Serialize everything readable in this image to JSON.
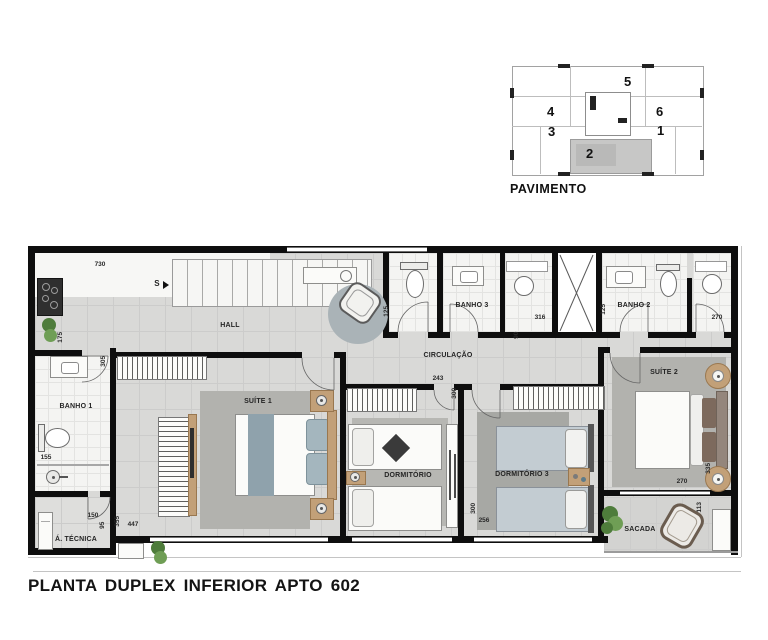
{
  "title": "PLANTA DUPLEX INFERIOR APTO 602",
  "keyplan": {
    "caption": "PAVIMENTO",
    "units": {
      "u1": "1",
      "u2": "2",
      "u3": "3",
      "u4": "4",
      "u5": "5",
      "u6": "6"
    }
  },
  "rooms": {
    "hall": "HALL",
    "circulacao": "CIRCULAÇÃO",
    "banho1": "BANHO 1",
    "banho2": "BANHO 2",
    "banho3": "BANHO 3",
    "suite1": "SUÍTE 1",
    "suite2": "SUÍTE 2",
    "dormitorio": "DORMITÓRIO",
    "dormitorio3": "DORMITÓRIO 3",
    "area_tecnica": "Á. TÉCNICA",
    "sacada": "SACADA",
    "stair_direction": "S"
  },
  "dims": {
    "kitchen_w": "730",
    "kitchen_h": "175",
    "suite1_top": "305",
    "lavabo_w": "125",
    "banho3_w": "316",
    "banho2_w": "125",
    "nook_w": "270",
    "circ_w": "90",
    "dorm_w": "243",
    "dorm_h": "300",
    "dorm3_h": "300",
    "dorm3_w": "256",
    "banho1_w": "155",
    "atec_w": "150",
    "atec_h": "95",
    "suite1_h": "355",
    "suite1_w": "447",
    "suite2_h": "335",
    "suite2_w": "270",
    "sacada_h": "113"
  }
}
